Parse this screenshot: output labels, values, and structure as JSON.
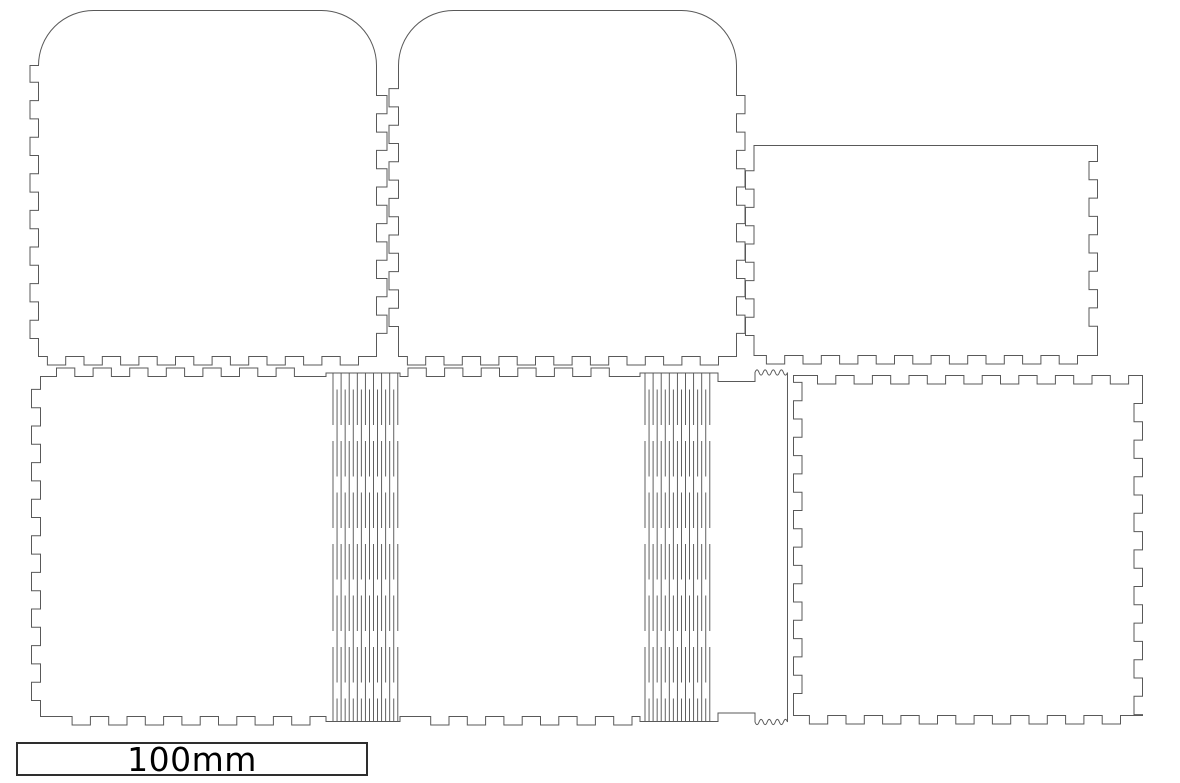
{
  "scale_bar": {
    "label": "100mm"
  },
  "colors": {
    "background": "#ffffff",
    "cut_line": "#595959",
    "hinge_line": "#4f4f4f",
    "scale_border": "#2e2e2e",
    "scale_text": "#000000"
  },
  "panels": [
    {
      "id": "panel-lid-left"
    },
    {
      "id": "panel-lid-right"
    },
    {
      "id": "panel-back"
    },
    {
      "id": "panel-body-living-hinge"
    },
    {
      "id": "panel-side-right"
    }
  ],
  "living_hinge": {
    "columns": 2,
    "lines_per_column": 17
  }
}
